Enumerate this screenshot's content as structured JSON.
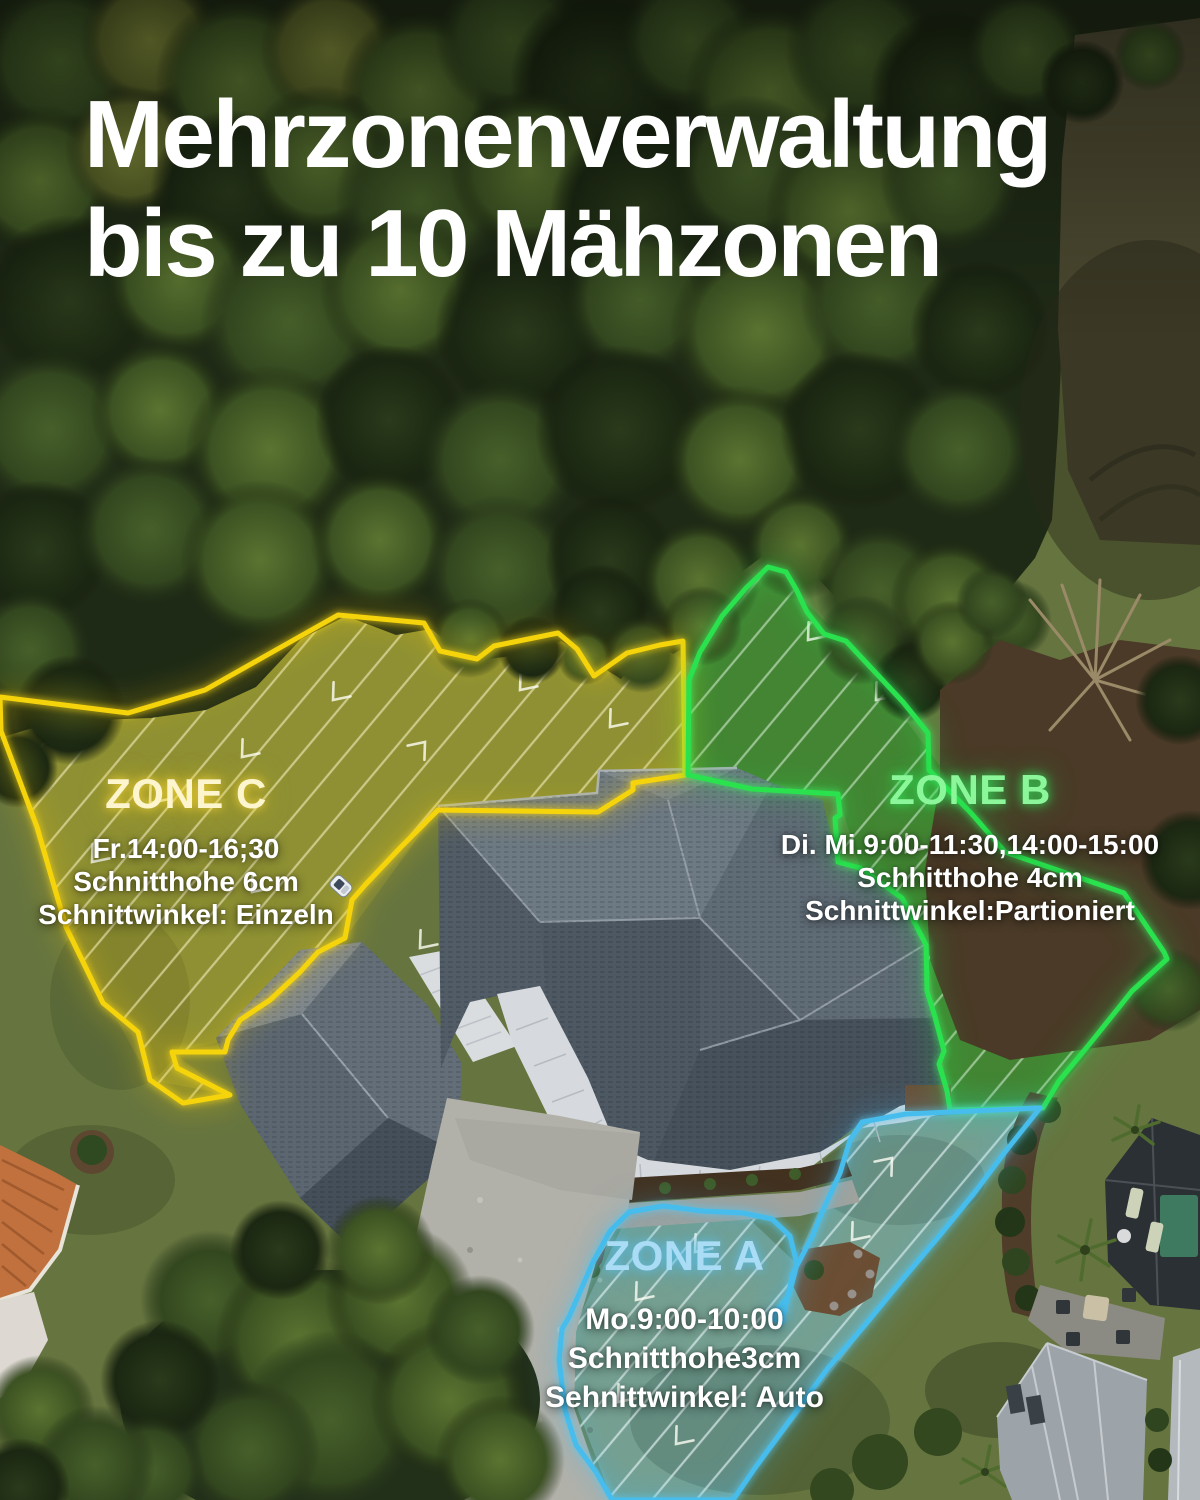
{
  "title": {
    "line1": "Mehrzonenverwaltung",
    "line2": "bis zu 10 Mähzonen"
  },
  "zones": [
    {
      "name": "ZONE C",
      "schedule": "Fr.14:00-16;30",
      "cut_height": "Schnitthohe 6cm",
      "cut_angle": "Schnittwinkel: Einzeln",
      "outline_color": "#f6d40b",
      "label_color": "#fcf5cd"
    },
    {
      "name": "ZONE B",
      "schedule": "Di. Mi.9:00-11:30,14:00-15:00",
      "cut_height": "Schhitthohe 4cm",
      "cut_angle": "Schnittwinkel:Partioniert",
      "outline_color": "#2ae24e",
      "label_color": "#8bf79a"
    },
    {
      "name": "ZONE A",
      "schedule": "Mo.9:00-10:00",
      "cut_height": "Schnitthohe3cm",
      "cut_angle": "Sehnittwinkel: Auto",
      "outline_color": "#46bdec",
      "label_color": "#aadcf5"
    }
  ]
}
